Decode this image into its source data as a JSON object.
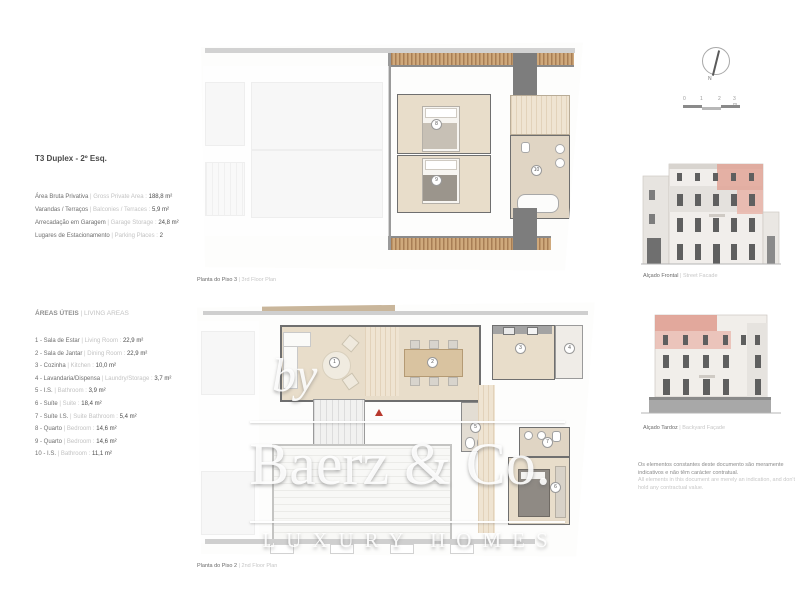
{
  "left_panel": {
    "title": "T3 Duplex - 2º Esq.",
    "summary": [
      {
        "pt": "Área Bruta Privativa",
        "en": "| Gross Private Area :",
        "value": "188,8 m²"
      },
      {
        "pt": "Varandas / Terraços",
        "en": "| Balconies / Terraces :",
        "value": "5,9 m²"
      },
      {
        "pt": "Arrecadação em Garagem",
        "en": "| Garage Storage :",
        "value": "24,8 m²"
      },
      {
        "pt": "Lugares de Estacionamento",
        "en": "| Parking Places :",
        "value": "2"
      }
    ],
    "heading": {
      "pt": "ÁREAS ÚTEIS",
      "en": "| LIVING AREAS"
    },
    "living_areas": [
      {
        "pt": "1 - Sala de Estar",
        "en": "| Living Room :",
        "value": "22,9 m²"
      },
      {
        "pt": "2 - Sala de Jantar",
        "en": "| Dining Room :",
        "value": "22,9 m²"
      },
      {
        "pt": "3 - Cozinha",
        "en": "| Kitchen :",
        "value": "10,0 m²"
      },
      {
        "pt": "4 - Lavandaria/Dispensa",
        "en": "| Laundry/Storage :",
        "value": "3,7 m²"
      },
      {
        "pt": "5 - I.S.",
        "en": "| Bathroom :",
        "value": "3,9 m²"
      },
      {
        "pt": "6 - Suíte",
        "en": "| Suite :",
        "value": "18,4 m²"
      },
      {
        "pt": "7 - Suíte I.S.",
        "en": "| Suite Bathroom :",
        "value": "5,4 m²"
      },
      {
        "pt": "8 - Quarto",
        "en": "| Bedroom :",
        "value": "14,6 m²"
      },
      {
        "pt": "9 - Quarto",
        "en": "| Bedroom :",
        "value": "14,6 m²"
      },
      {
        "pt": "10 - I.S.",
        "en": "| Bathroom :",
        "value": "11,1 m²"
      }
    ]
  },
  "plans": {
    "floor3": {
      "caption_pt": "Planta do Piso 3",
      "caption_en": "| 3rd Floor Plan",
      "badges": [
        "8",
        "9",
        "10"
      ]
    },
    "floor2": {
      "caption_pt": "Planta do Piso 2",
      "caption_en": "| 2nd Floor Plan",
      "badges": [
        "1",
        "2",
        "3",
        "4",
        "5",
        "6",
        "7"
      ]
    }
  },
  "right_panel": {
    "compass_label": "N",
    "scale_ticks": [
      "0",
      "1",
      "2",
      "3 m"
    ],
    "elevations": [
      {
        "caption_pt": "Alçado Frontal",
        "caption_en": "| Street Facade"
      },
      {
        "caption_pt": "Alçado Tardoz",
        "caption_en": "| Backyard Façade"
      }
    ],
    "disclaimer_pt": "Os elementos constantes deste documento são meramente indicativos e não têm carácter contratual.",
    "disclaimer_en": "All elements in this document are merely an indication, and don't hold any contractual value."
  },
  "watermark": {
    "by": "by",
    "brand": "Baerz & Co.",
    "tagline": "LUXURY HOMES"
  },
  "colors": {
    "highlight_pink": "#e2a598",
    "wood_brown": "#a87e55",
    "floor_beige": "#e8ddca",
    "accent_red": "#b8392e"
  }
}
